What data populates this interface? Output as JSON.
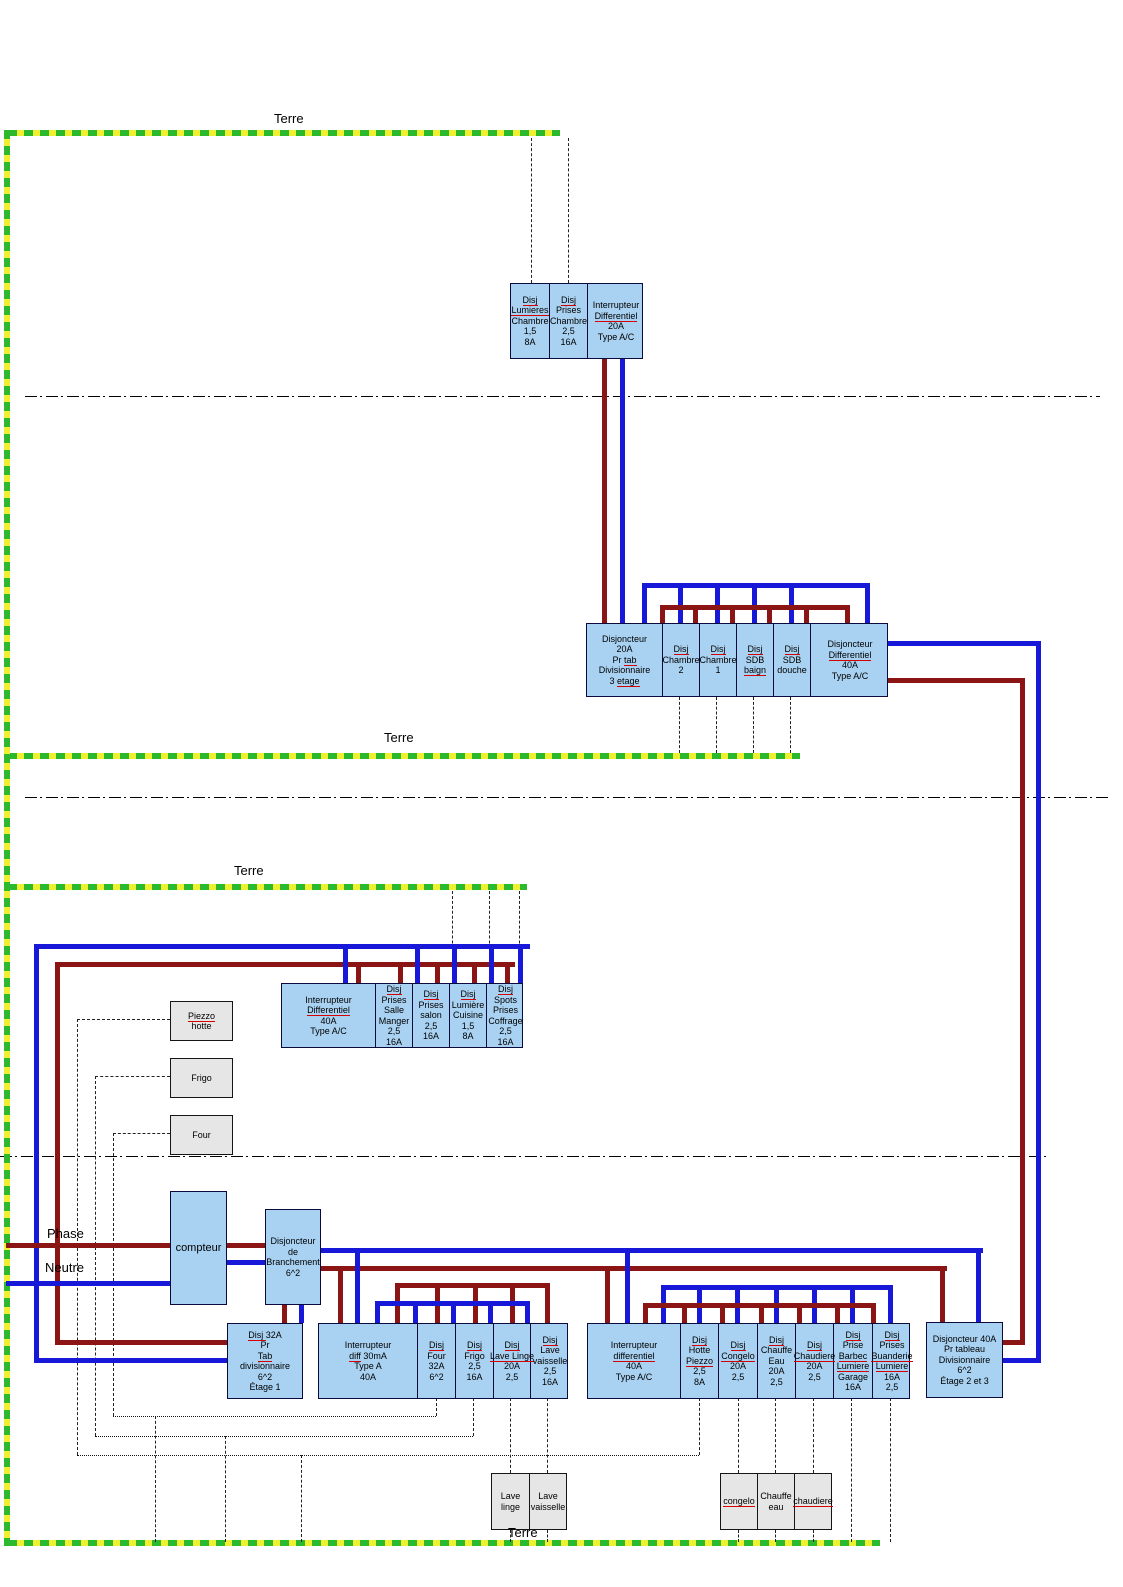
{
  "colors": {
    "phase_wire": "#8b1414",
    "neutre_wire": "#1818d8",
    "earth_green": "#2db92d",
    "earth_yellow": "#f0f032",
    "panel_fill": "#a9d2f2",
    "appliance_fill": "#e6e6e6",
    "misspell_underline": "#d40000"
  },
  "labels": [
    {
      "name": "terre-label-top",
      "text": "Terre",
      "x": 274,
      "y": 112
    },
    {
      "name": "terre-label-middle",
      "text": "Terre",
      "x": 384,
      "y": 731
    },
    {
      "name": "terre-label-rdc",
      "text": "Terre",
      "x": 234,
      "y": 864
    },
    {
      "name": "terre-label-bottom",
      "text": "Terre",
      "x": 508,
      "y": 1526
    },
    {
      "name": "phase-label",
      "text": "Phase",
      "x": 47,
      "y": 1227
    },
    {
      "name": "neutre-label",
      "text": "Neutre",
      "x": 45,
      "y": 1261
    }
  ],
  "panels": [
    {
      "name": "chambre3-panel",
      "x": 510,
      "y": 283,
      "w": 133,
      "h": 76,
      "cells": [
        {
          "name": "disj-lumieres-chambre",
          "w": 39,
          "lines": [
            [
              {
                "t": "Disj",
                "u": true
              }
            ],
            [
              {
                "t": "Lumieres",
                "u": true
              }
            ],
            "Chambre",
            "1,5",
            "8A"
          ]
        },
        {
          "name": "disj-prises-chambre",
          "w": 38,
          "lines": [
            [
              {
                "t": "Disj",
                "u": true
              }
            ],
            "Prises",
            "Chambre",
            "2,5",
            "16A"
          ]
        },
        {
          "name": "interrupteur-differentiel-20a",
          "w": 56,
          "lines": [
            "Interrupteur",
            [
              {
                "t": "Differentiel",
                "u": true
              }
            ],
            "20A",
            "Type A/C"
          ]
        }
      ]
    },
    {
      "name": "etage3-feed-panel",
      "x": 586,
      "y": 623,
      "w": 302,
      "h": 74,
      "cells": [
        {
          "name": "disjoncteur-20a-pr-tab-divisionnaire",
          "w": 76,
          "lines": [
            "Disjoncteur",
            "20A",
            [
              {
                "t": "Pr "
              },
              {
                "t": "tab",
                "u": true
              }
            ],
            "Divisionnaire",
            [
              {
                "t": "3 "
              },
              {
                "t": "etage",
                "u": true
              }
            ]
          ]
        },
        {
          "name": "disj-chambre-2",
          "w": 37,
          "lines": [
            [
              {
                "t": "Disj",
                "u": true
              }
            ],
            "Chambre",
            "2"
          ]
        },
        {
          "name": "disj-chambre-1",
          "w": 37,
          "lines": [
            [
              {
                "t": "Disj",
                "u": true
              }
            ],
            "Chambre",
            "1"
          ]
        },
        {
          "name": "disj-sdb-baignoire",
          "w": 37,
          "lines": [
            [
              {
                "t": "Disj",
                "u": true
              }
            ],
            "SDB",
            [
              {
                "t": "baign",
                "u": true
              }
            ]
          ]
        },
        {
          "name": "disj-sdb-douche",
          "w": 37,
          "lines": [
            [
              {
                "t": "Disj",
                "u": true
              }
            ],
            "SDB",
            "douche"
          ]
        },
        {
          "name": "disjoncteur-differentiel-40a",
          "w": 78,
          "lines": [
            "Disjoncteur",
            [
              {
                "t": "Differentiel",
                "u": true
              }
            ],
            "40A",
            "Type A/C"
          ]
        }
      ]
    },
    {
      "name": "rdc-panel",
      "x": 281,
      "y": 983,
      "w": 242,
      "h": 65,
      "cells": [
        {
          "name": "interrupteur-differentiel-40a-rdc",
          "w": 94,
          "lines": [
            "Interrupteur",
            [
              {
                "t": "Differentiel",
                "u": true
              }
            ],
            "40A",
            "Type A/C"
          ]
        },
        {
          "name": "disj-prises-salle-manger",
          "w": 37,
          "lines": [
            [
              {
                "t": "Disj",
                "u": true
              }
            ],
            "Prises",
            "Salle",
            "Manger",
            "2,5",
            "16A"
          ]
        },
        {
          "name": "disj-prises-salon",
          "w": 37,
          "lines": [
            [
              {
                "t": "Disj",
                "u": true
              }
            ],
            "Prises",
            "salon",
            "2,5",
            "16A"
          ]
        },
        {
          "name": "disj-lumiere-cuisine",
          "w": 37,
          "lines": [
            [
              {
                "t": "Disj",
                "u": true
              }
            ],
            "Lumière",
            "Cuisine",
            "1,5",
            "8A"
          ]
        },
        {
          "name": "disj-spots-prises-coffrage",
          "w": 37,
          "lines": [
            [
              {
                "t": "Disj",
                "u": true
              }
            ],
            "Spots",
            "Prises",
            "Coffrage",
            "2,5",
            "16A"
          ]
        }
      ]
    },
    {
      "name": "piezzo-hotte-box",
      "type": "gray",
      "x": 170,
      "y": 1001,
      "w": 63,
      "h": 40,
      "cells": [
        {
          "name": "piezzo-hotte-appliance",
          "w": 61,
          "lines": [
            [
              {
                "t": "Piezzo",
                "u": true
              }
            ],
            "hotte"
          ]
        }
      ]
    },
    {
      "name": "frigo-box",
      "type": "gray",
      "x": 170,
      "y": 1058,
      "w": 63,
      "h": 40,
      "cells": [
        {
          "name": "frigo-appliance",
          "w": 61,
          "lines": [
            "Frigo"
          ]
        }
      ]
    },
    {
      "name": "four-box",
      "type": "gray",
      "x": 170,
      "y": 1115,
      "w": 63,
      "h": 40,
      "cells": [
        {
          "name": "four-appliance",
          "w": 61,
          "lines": [
            "Four"
          ]
        }
      ]
    },
    {
      "name": "compteur-box",
      "fs": 11,
      "x": 170,
      "y": 1191,
      "w": 57,
      "h": 114,
      "cells": [
        {
          "name": "compteur",
          "w": 55,
          "lines": [
            "compteur"
          ]
        }
      ]
    },
    {
      "name": "disjoncteur-branchement-box",
      "x": 265,
      "y": 1209,
      "w": 56,
      "h": 96,
      "cells": [
        {
          "name": "disjoncteur-de-branchement",
          "w": 54,
          "lines": [
            "Disjoncteur",
            "de",
            "Branchement",
            "6^2"
          ]
        }
      ]
    },
    {
      "name": "etage1-feed-box",
      "x": 227,
      "y": 1323,
      "w": 76,
      "h": 76,
      "cells": [
        {
          "name": "disj-32a-pr-tab-divisionnaire-etage1",
          "w": 74,
          "lines": [
            [
              {
                "t": "Disj ",
                "u": true
              },
              {
                "t": "32A"
              }
            ],
            "Pr",
            [
              {
                "t": "Tab",
                "u": true
              }
            ],
            "divisionnaire",
            "6^2",
            "Étage 1"
          ]
        }
      ]
    },
    {
      "name": "etage1-appliance-panel",
      "x": 318,
      "y": 1323,
      "w": 250,
      "h": 76,
      "cells": [
        {
          "name": "interrupteur-diff-30ma",
          "w": 99,
          "lines": [
            "Interrupteur",
            [
              {
                "t": "diff",
                "u": true
              },
              {
                "t": " 30mA"
              }
            ],
            "Type A",
            "40A"
          ]
        },
        {
          "name": "disj-four",
          "w": 38,
          "lines": [
            [
              {
                "t": "Disj",
                "u": true
              }
            ],
            "Four",
            "32A",
            "6^2"
          ]
        },
        {
          "name": "disj-frigo",
          "w": 38,
          "lines": [
            [
              {
                "t": "Disj",
                "u": true
              }
            ],
            "Frigo",
            "2,5",
            "16A"
          ]
        },
        {
          "name": "disj-lave-linge",
          "w": 37,
          "lines": [
            [
              {
                "t": "Disj",
                "u": true
              }
            ],
            [
              {
                "t": "Lave Linge",
                "u": true
              }
            ],
            "20A",
            "2,5"
          ]
        },
        {
          "name": "disj-lave-vaisselle",
          "w": 38,
          "lines": [
            [
              {
                "t": "Disj",
                "u": true
              }
            ],
            "Lave",
            "vaisselle",
            "2,5",
            "16A"
          ]
        }
      ]
    },
    {
      "name": "utility-panel",
      "x": 587,
      "y": 1323,
      "w": 323,
      "h": 76,
      "cells": [
        {
          "name": "interrupteur-differentiel-40a-utility",
          "w": 93,
          "lines": [
            "Interrupteur",
            [
              {
                "t": "differentiel",
                "u": true
              }
            ],
            "40A",
            "Type A/C"
          ]
        },
        {
          "name": "disj-hotte-piezzo",
          "w": 38,
          "lines": [
            [
              {
                "t": "Disj",
                "u": true
              }
            ],
            "Hotte",
            [
              {
                "t": "Piezzo",
                "u": true
              }
            ],
            "2,5",
            "8A"
          ]
        },
        {
          "name": "disj-congelo",
          "w": 39,
          "lines": [
            [
              {
                "t": "Disj",
                "u": true
              }
            ],
            [
              {
                "t": "Congelo",
                "u": true
              }
            ],
            "20A",
            "2,5"
          ]
        },
        {
          "name": "disj-chauffe-eau",
          "w": 38,
          "lines": [
            [
              {
                "t": "Disj",
                "u": true
              }
            ],
            "Chauffe",
            "Eau",
            "20A",
            "2,5"
          ]
        },
        {
          "name": "disj-chaudiere",
          "w": 38,
          "lines": [
            [
              {
                "t": "Disj",
                "u": true
              }
            ],
            [
              {
                "t": "Chaudiere",
                "u": true
              }
            ],
            "20A",
            "2,5"
          ]
        },
        {
          "name": "disj-prise-barbec-lumiere-garage",
          "w": 39,
          "lines": [
            [
              {
                "t": "Disj",
                "u": true
              }
            ],
            "Prise",
            [
              {
                "t": "Barbec",
                "u": true
              }
            ],
            [
              {
                "t": "Lumiere",
                "u": true
              }
            ],
            "Garage",
            "16A"
          ]
        },
        {
          "name": "disj-prises-buanderie-lumiere",
          "w": 38,
          "lines": [
            [
              {
                "t": "Disj",
                "u": true
              }
            ],
            "Prises",
            [
              {
                "t": "Buanderie",
                "u": true
              }
            ],
            [
              {
                "t": "Lumiere",
                "u": true
              }
            ],
            "16A",
            "2,5"
          ]
        }
      ]
    },
    {
      "name": "etage23-feed-box",
      "x": 926,
      "y": 1322,
      "w": 77,
      "h": 76,
      "cells": [
        {
          "name": "disjoncteur-40a-pr-tableau-etage23",
          "w": 75,
          "lines": [
            "Disjoncteur 40A",
            "Pr tableau",
            "Divisionnaire",
            "6^2",
            "Étage 2 et 3"
          ]
        }
      ]
    },
    {
      "name": "lave-appliance-panel",
      "type": "gray",
      "x": 491,
      "y": 1473,
      "w": 76,
      "h": 57,
      "cells": [
        {
          "name": "lave-linge-appliance",
          "w": 38,
          "lines": [
            "Lave",
            "linge"
          ]
        },
        {
          "name": "lave-vaisselle-appliance",
          "w": 36,
          "lines": [
            "Lave",
            "vaisselle"
          ]
        }
      ]
    },
    {
      "name": "chauffage-appliance-panel",
      "type": "gray",
      "x": 720,
      "y": 1473,
      "w": 112,
      "h": 57,
      "cells": [
        {
          "name": "congelo-appliance",
          "w": 37,
          "lines": [
            [
              {
                "t": "congelo",
                "u": true
              }
            ]
          ]
        },
        {
          "name": "chauffe-eau-appliance",
          "w": 37,
          "lines": [
            "Chauffe",
            "eau"
          ]
        },
        {
          "name": "chaudiere-appliance",
          "w": 36,
          "lines": [
            [
              {
                "t": "chaudiere",
                "u": true
              }
            ]
          ]
        }
      ]
    }
  ]
}
